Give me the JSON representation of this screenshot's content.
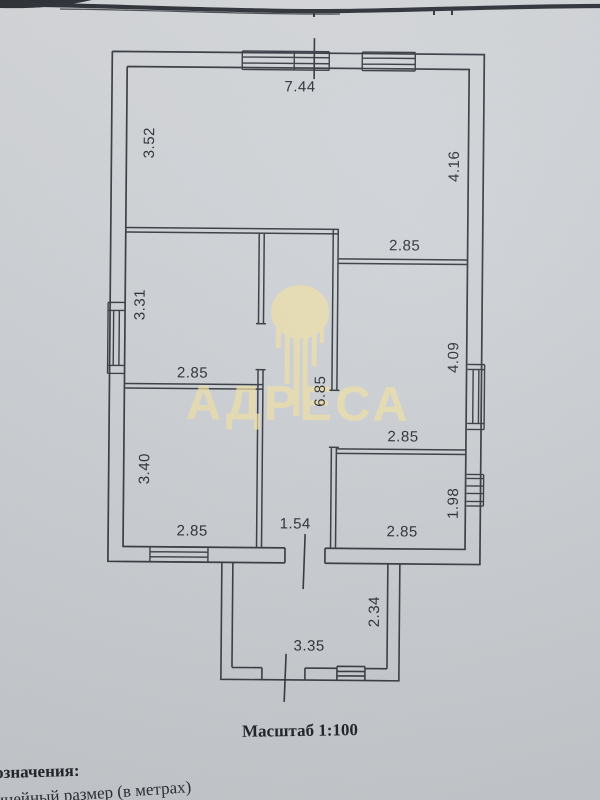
{
  "document": {
    "scale_caption": "Масштаб 1:100",
    "legend_heading_cut": "означения:",
    "legend_item_cut": "инейный размер (в метрах)"
  },
  "watermark": {
    "text": "АДРЕСА",
    "color": "#efe0a8"
  },
  "floor_plan": {
    "wall_color": "#383c43",
    "paper_color": "#cdd1d5",
    "labels": [
      {
        "id": "top-wall-width",
        "text": "7.44"
      },
      {
        "id": "living-room-left-height",
        "text": "3.52"
      },
      {
        "id": "living-room-right-height",
        "text": "4.16"
      },
      {
        "id": "living-room-right-width",
        "text": "2.85"
      },
      {
        "id": "left-middle-room-height",
        "text": "3.31"
      },
      {
        "id": "left-middle-room-width",
        "text": "2.85"
      },
      {
        "id": "right-upper-room-height",
        "text": "4.09"
      },
      {
        "id": "hallway-length",
        "text": "6.85"
      },
      {
        "id": "right-upper-room-width",
        "text": "2.85"
      },
      {
        "id": "left-lower-room-height",
        "text": "3.40"
      },
      {
        "id": "right-lower-room-height",
        "text": "1.98"
      },
      {
        "id": "left-lower-room-width",
        "text": "2.85"
      },
      {
        "id": "hallway-width",
        "text": "1.54"
      },
      {
        "id": "right-lower-room-width",
        "text": "2.85"
      },
      {
        "id": "porch-height",
        "text": "2.34"
      },
      {
        "id": "porch-width",
        "text": "3.35"
      }
    ]
  }
}
